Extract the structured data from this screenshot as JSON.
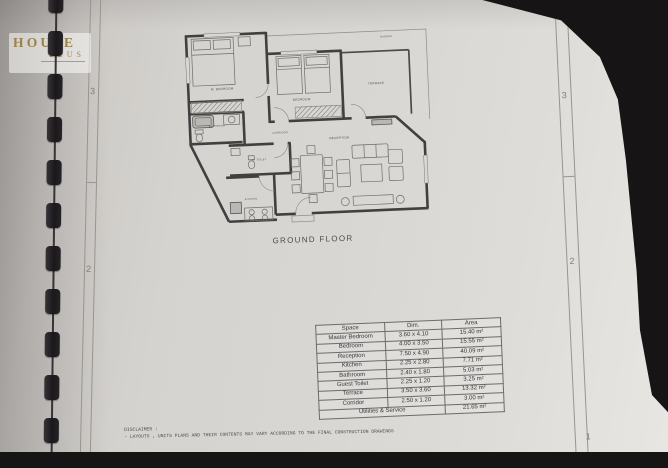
{
  "watermark": {
    "line1": "HOUSE",
    "line2": "PLUS"
  },
  "plan": {
    "title": "GROUND FLOOR",
    "rooms": {
      "garden": "GARDEN",
      "master_bedroom": "M. BEDROOM",
      "bedroom": "BEDROOM",
      "terrace": "TERRACE",
      "bathroom": "BATHROOM",
      "corridor": "CORRIDOR",
      "guest_toilet": "G. TOILET",
      "kitchen": "KITCHEN",
      "reception": "RECEPTION"
    }
  },
  "table": {
    "headers": [
      "Space",
      "Dim.",
      "Area"
    ],
    "rows": [
      [
        "Master Bedroom",
        "3.60 x 4.10",
        "15.40 m²"
      ],
      [
        "Bedroom",
        "4.00 x 3.50",
        "15.55 m²"
      ],
      [
        "Reception",
        "7.50 x 4.90",
        "40.09 m²"
      ],
      [
        "Kitchen",
        "2.25 x 2.80",
        "7.71 m²"
      ],
      [
        "Bathroom",
        "2.40 x 1.80",
        "5.03 m²"
      ],
      [
        "Guest Toilet",
        "2.25 x 1.20",
        "3.25 m²"
      ],
      [
        "Terrace",
        "3.50 x 3.60",
        "13.32 m²"
      ],
      [
        "Corridor",
        "2.50 x 1.20",
        "3.00 m²"
      ]
    ],
    "footer": {
      "label": "Utilities & Service",
      "value": "21.65 m²"
    }
  },
  "disclaimer": {
    "line1": "DISCLAIMER :",
    "line2": "- LAYOUTS , UNITS PLANS AND THEIR CONTENTS MAY VARY ACCORDING TO THE FINAL CONSTRUCTION DRAWINGS"
  },
  "margin_marks": {
    "left": [
      "3",
      "2"
    ],
    "right": [
      "3",
      "2",
      "1"
    ]
  },
  "colors": {
    "gold": "#99814a",
    "paper": "#d7d5d1",
    "wall": "#413f40",
    "background": "#171416"
  }
}
